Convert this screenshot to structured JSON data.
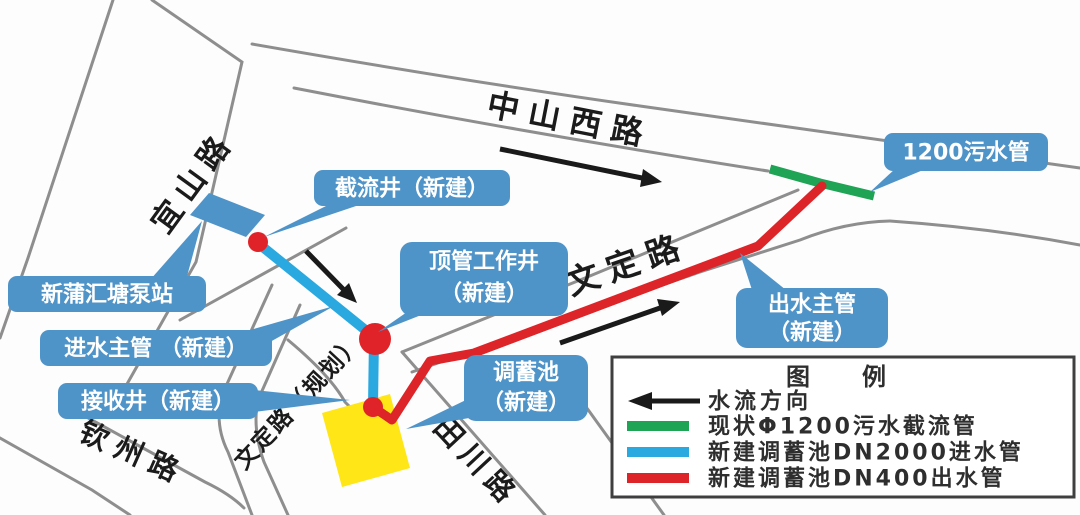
{
  "map": {
    "roads": {
      "zhongshan": "中山西路",
      "yishan": "宜山路",
      "wending": "文定路",
      "wending_planned": "文定路（规划）",
      "qinzhou": "钦州路",
      "tianchuan": "田川路"
    },
    "callouts": {
      "intercept_well": "截流井（新建）",
      "jacking_well_line1": "顶管工作井",
      "jacking_well_line2": "（新建）",
      "pump_station": "新蒲汇塘泵站",
      "inlet_main": "进水主管 （新建）",
      "receiving_well": "接收井（新建）",
      "storage_tank_line1": "调蓄池",
      "storage_tank_line2": "（新建）",
      "outlet_main_line1": "出水主管",
      "outlet_main_line2": "（新建）",
      "sewer_pipe": "1200污水管"
    }
  },
  "legend": {
    "title": "图　例",
    "items": [
      {
        "label": "水流方向",
        "type": "arrow",
        "color": "#1a1a1a"
      },
      {
        "label": "现状Φ1200污水截流管",
        "type": "line",
        "color": "#1fa355"
      },
      {
        "label": "新建调蓄池DN2000进水管",
        "type": "line",
        "color": "#2aa9e0"
      },
      {
        "label": "新建调蓄池DN400出水管",
        "type": "line",
        "color": "#dd2428"
      }
    ]
  },
  "colors": {
    "callout_bg": "#4f94c8",
    "pipe_existing": "#1fa355",
    "pipe_inlet": "#2aa9e0",
    "pipe_outlet": "#dd2428",
    "node_red": "#e02329",
    "tank_yellow": "#ffe617",
    "pump_blue": "#4f94c8",
    "road_gray": "#8e8e8e",
    "arrow_black": "#1a1a1a"
  }
}
